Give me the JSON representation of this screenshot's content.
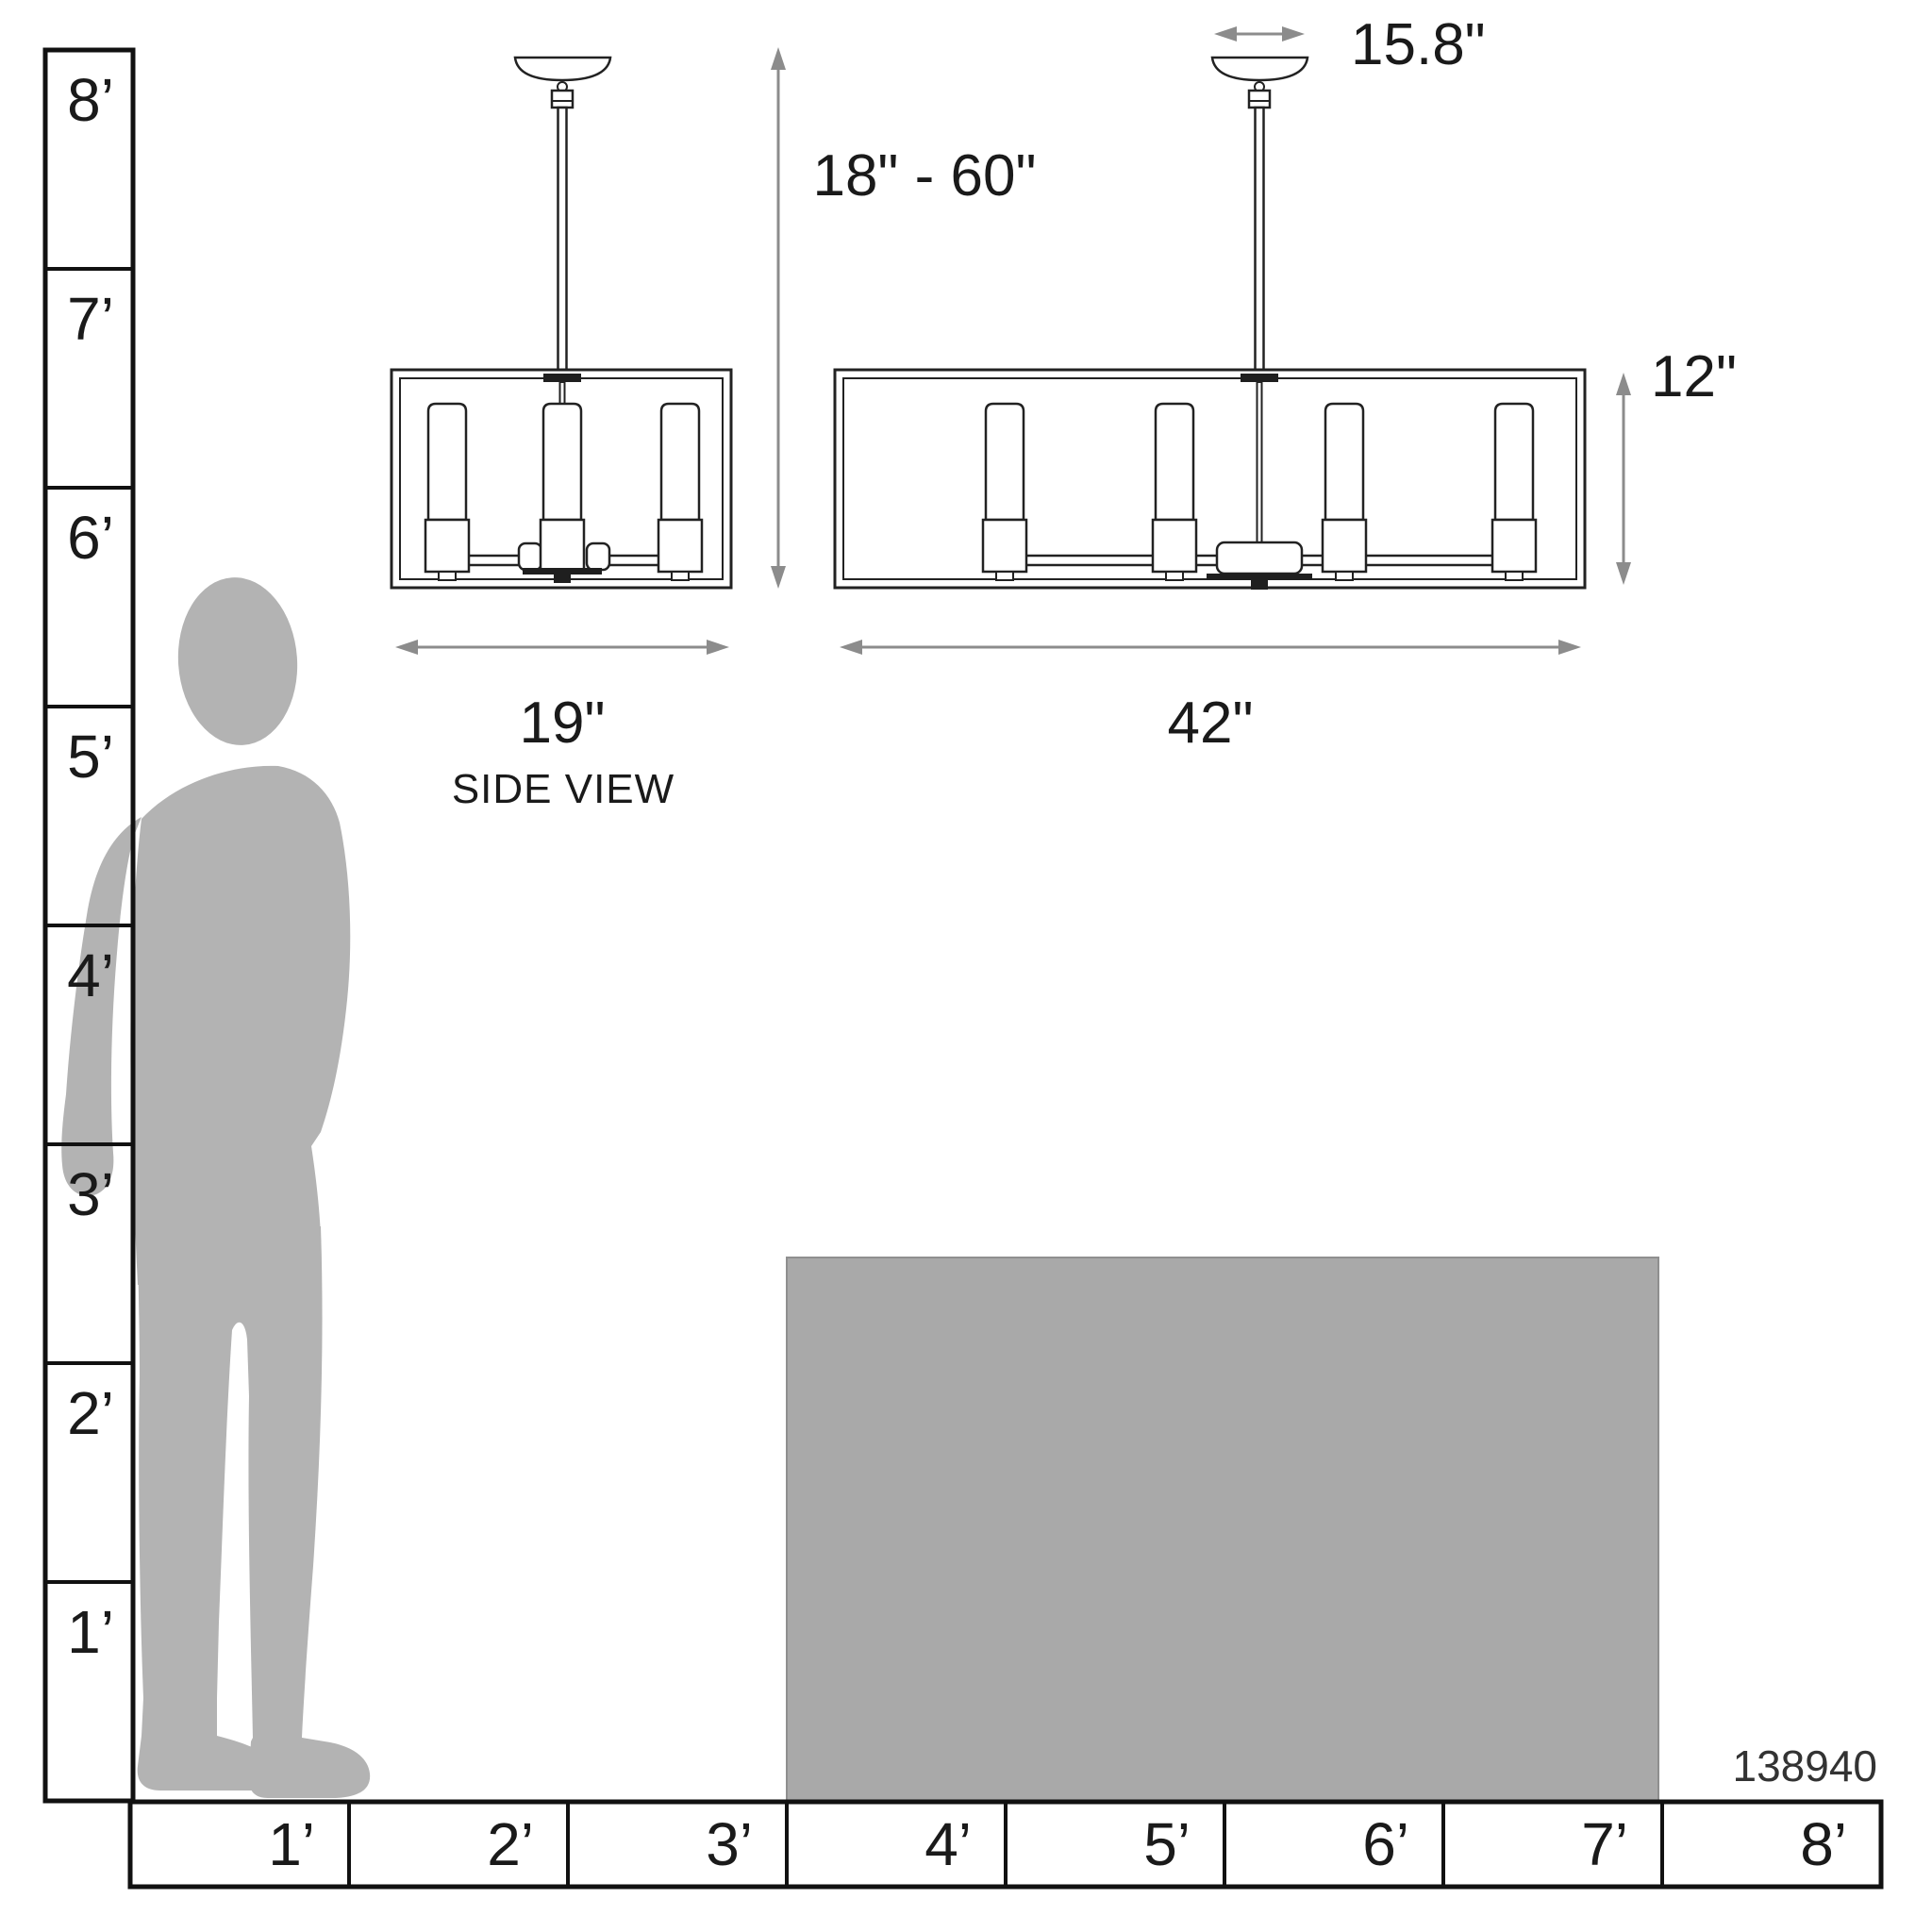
{
  "product_code": "138940",
  "side_view": {
    "width": "19\"",
    "caption": "SIDE VIEW"
  },
  "front_view": {
    "canopy_width": "15.8\"",
    "suspension_range": "18\" - 60\"",
    "shade_height": "12\"",
    "width": "42\""
  },
  "vertical_ruler": {
    "labels": [
      "8’",
      "7’",
      "6’",
      "5’",
      "4’",
      "3’",
      "2’",
      "1’"
    ]
  },
  "horizontal_ruler": {
    "labels": [
      "1’",
      "2’",
      "3’",
      "4’",
      "5’",
      "6’",
      "7’",
      "8’"
    ]
  },
  "colors": {
    "silhouette": "#b3b3b3",
    "table": "#a9a9a9",
    "line": "#222222",
    "arrow": "#8c8c8c"
  }
}
